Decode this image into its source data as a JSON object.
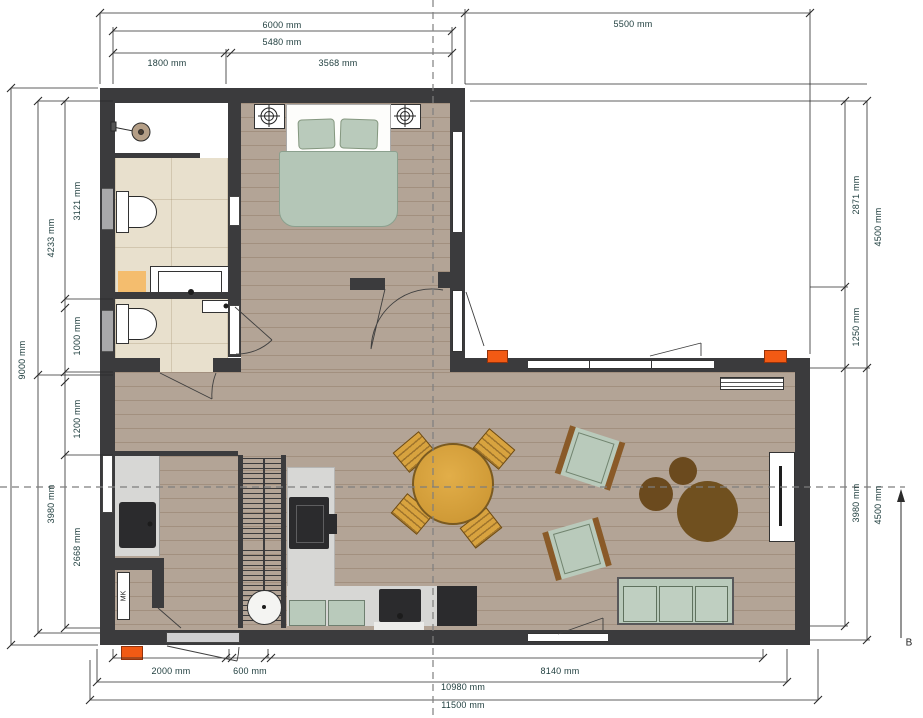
{
  "drawing": {
    "type": "floor-plan",
    "units": "mm",
    "section_marker": "B",
    "meter_cabinet_label": "MK"
  },
  "dims": {
    "top_6000": "6000 mm",
    "top_5480": "5480 mm",
    "top_1800": "1800 mm",
    "top_3568": "3568 mm",
    "top_5500": "5500 mm",
    "left_9000": "9000 mm",
    "left_4233": "4233 mm",
    "left_3121": "3121 mm",
    "left_1000": "1000 mm",
    "left_1200": "1200 mm",
    "left_3980": "3980 mm",
    "left_2668": "2668 mm",
    "right_2871": "2871 mm",
    "right_4500_upper": "4500 mm",
    "right_1250": "1250 mm",
    "right_3980": "3980 mm",
    "right_4500_lower": "4500 mm",
    "bottom_2000": "2000 mm",
    "bottom_600": "600 mm",
    "bottom_8140": "8140 mm",
    "bottom_10980": "10980 mm",
    "bottom_11500": "11500 mm"
  },
  "colors": {
    "wall": "#3b3b3d",
    "wood": "#b3a496",
    "tile": "#e8e0cd",
    "sage": "#b9cabb",
    "woodfurn": "#d8a33f",
    "rug": "#6b4a1e",
    "orange": "#f25a14",
    "counter": "#d7d7d5",
    "dark": "#2b2b2d",
    "dimtext": "#1d3c3c",
    "mat": "#f4bd6e"
  }
}
